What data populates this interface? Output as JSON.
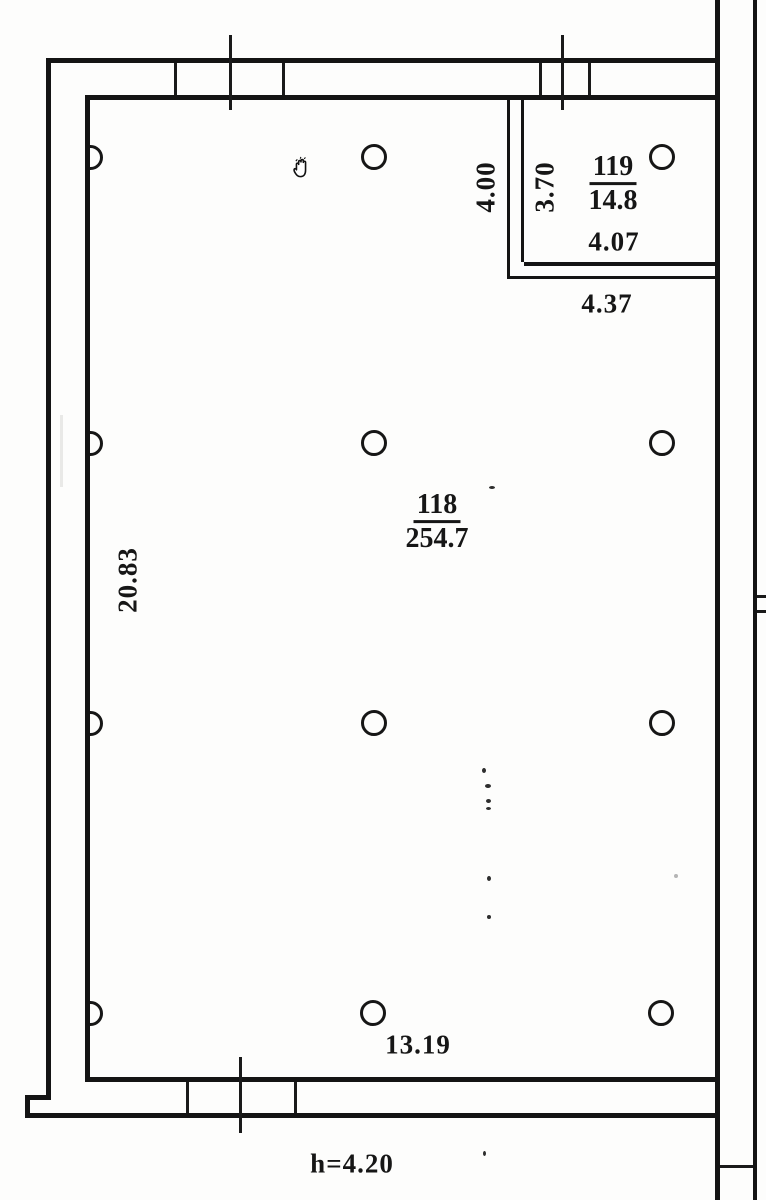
{
  "colors": {
    "ink": "#161616",
    "paper": "#fdfdfc"
  },
  "rooms": {
    "main": {
      "number": "118",
      "area": "254.7"
    },
    "small": {
      "number": "119",
      "area": "14.8"
    }
  },
  "dimensions": {
    "partition_height": "4.00",
    "small_room_height": "3.70",
    "small_room_width": "4.07",
    "small_room_outer_width": "4.37",
    "main_room_height": "20.83",
    "main_room_width": "13.19",
    "ceiling_height": "h=4.20"
  },
  "icons": {
    "cursor": "hand-grab-cursor-icon"
  }
}
